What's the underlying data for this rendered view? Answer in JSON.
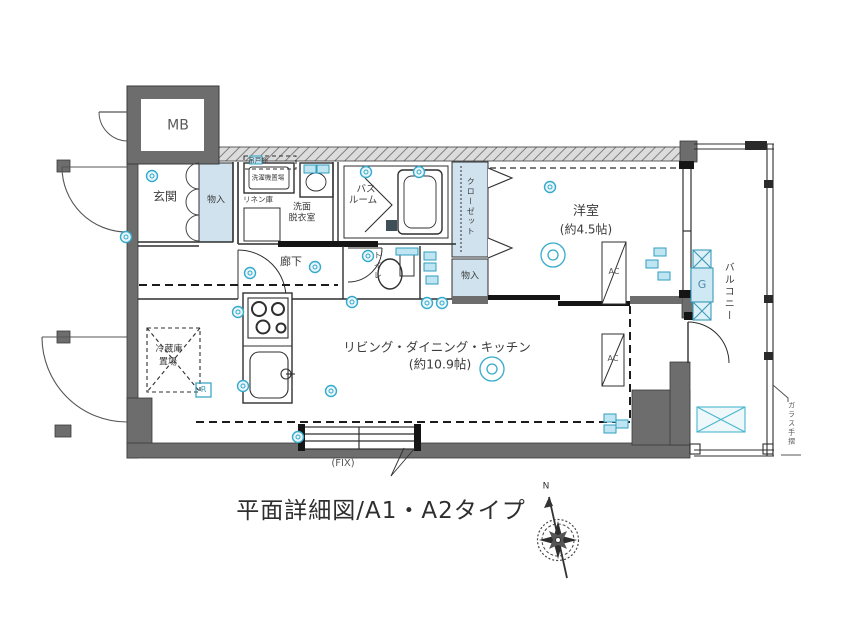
{
  "title": "平面詳細図/A1・A2タイプ",
  "compass": {
    "north": "N"
  },
  "plan": {
    "rooms": {
      "mb": "MB",
      "entrance": "玄関",
      "entrance_storage": "物入",
      "hanging_cupboard": "吊戸棚",
      "washing_machine_area": "洗濯機置場",
      "linen_storage": "リネン庫",
      "washroom_line1": "洗面",
      "washroom_line2": "脱衣室",
      "bathroom_line1": "バス",
      "bathroom_line2": "ルーム",
      "toilet": "トイレ",
      "corridor": "廊下",
      "closet": "クローゼット",
      "western_room": "洋室",
      "western_room_size": "(約4.5帖)",
      "western_room_storage": "物入",
      "ldk": "リビング・ダイニング・キッチン",
      "ldk_size": "(約10.9帖)",
      "refrigerator_line1": "冷蔵庫",
      "refrigerator_line2": "置場",
      "balcony": "バルコニー",
      "glass_railing": "ガラス手摺"
    },
    "marks": {
      "fix_window": "(FIX)",
      "ac_unit": "AC",
      "gas_meter": "G",
      "range_mark": "R"
    }
  },
  "colors": {
    "background": "#ffffff",
    "wall_gray": "#6d6d6d",
    "line_black": "#2f2f2f",
    "symbol_cyan": "#35aacb",
    "shaded_blue": "#cfe2ee"
  }
}
